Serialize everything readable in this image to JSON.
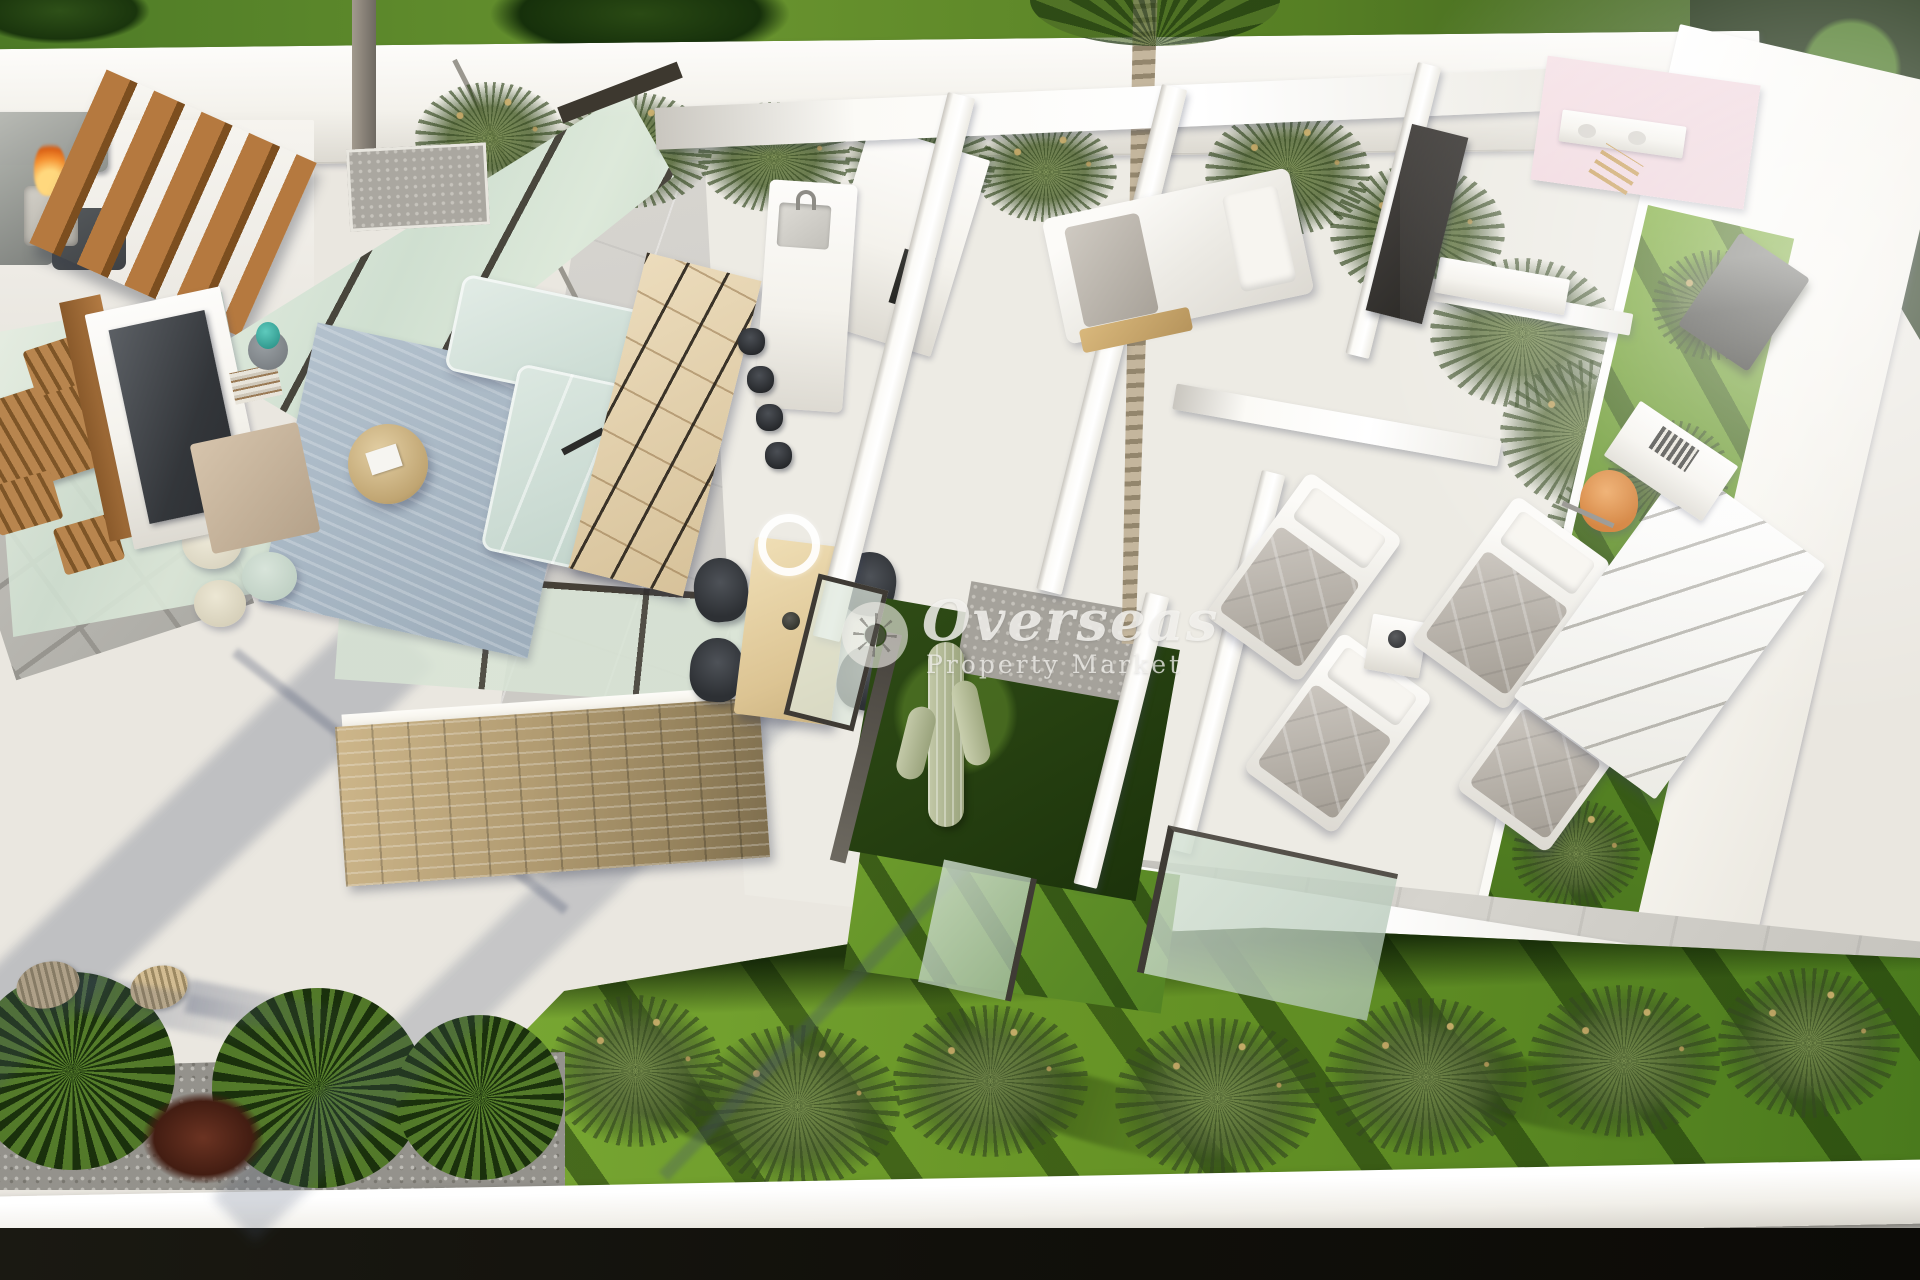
{
  "meta": {
    "type": "3d-architectural-render",
    "description": "Aerial cutaway 3D floor plan render of a modern single-storey villa: outdoor lounge with fire pit and pergola slats, glass-walled living and dining area, kitchen island, interior cactus courtyard with palm, three bedrooms with bathrooms, and a landscaped garden with ornamental grasses inside white perimeter walls"
  },
  "watermark": {
    "brand": "Overseas",
    "tagline": "Property Market",
    "icon": "sun-icon"
  },
  "palette": {
    "terrace": "#eae7e0",
    "wall_white": "#f8f7f3",
    "wall_shade": "#d9d6cf",
    "lawn": "#6f9a2e",
    "lawn_dark": "#24400f",
    "glass_mint": "#d6e2d3",
    "wood": "#b47a42",
    "stone": "#c0a97d",
    "sofa_mint": "#d2e1d9",
    "rug_blue": "#aab9c6",
    "chair_dark": "#3a3d41",
    "accent_orange": "#e0873c",
    "fire_orange": "#ef8b2d",
    "gravel": "#a9a6a0",
    "ground_dark": "#16150f",
    "shadow_blue": "rgba(70,80,110,0.28)"
  }
}
